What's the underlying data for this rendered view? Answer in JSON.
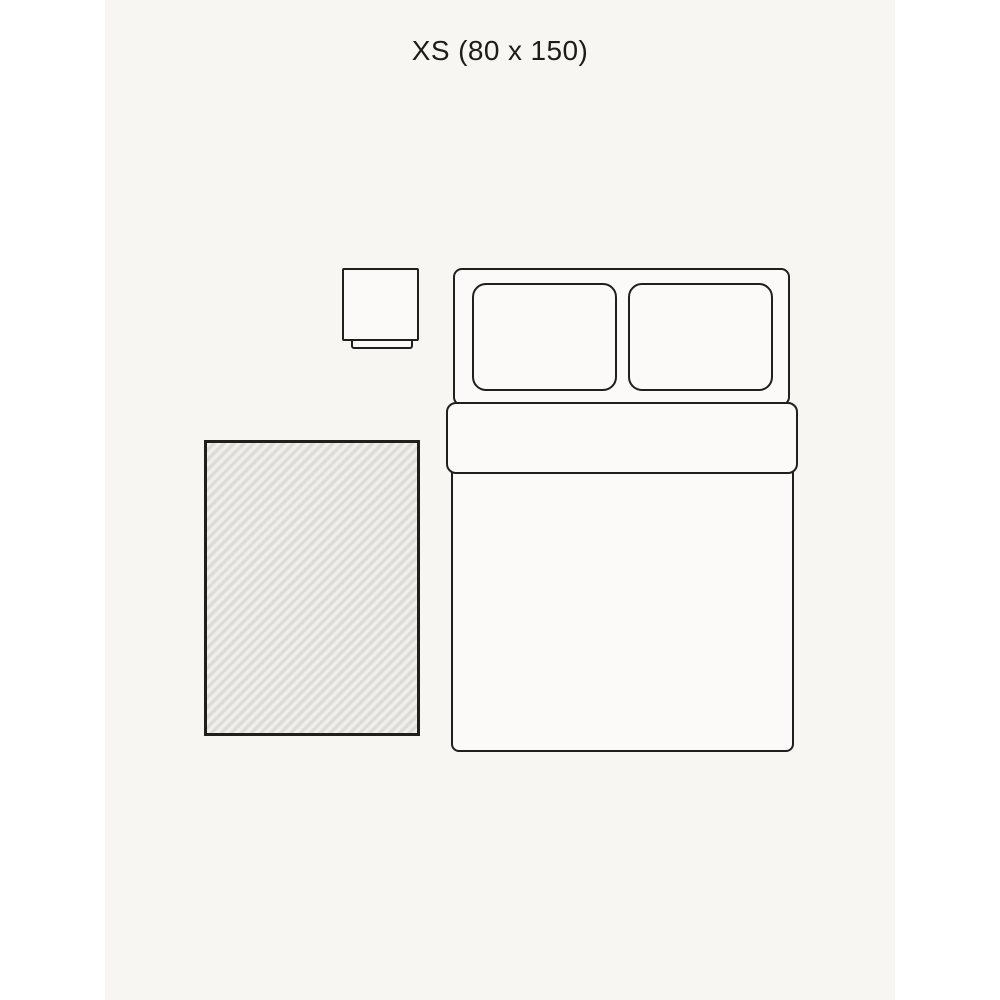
{
  "title": {
    "text": "XS (80 x 150)"
  },
  "size": {
    "label": "XS",
    "width_cm": "80",
    "length_cm": "150"
  },
  "colors": {
    "canvas": "#ffffff",
    "background": "#f7f6f3",
    "line": "#201f1d",
    "furniture_fill": "#fbfaf8",
    "rug_stripe_light": "#f0efec",
    "rug_stripe_dark": "#dddcd9",
    "text": "#1d1c1a"
  },
  "shapes": [
    {
      "name": "rug",
      "pattern": "diagonal-hatch"
    },
    {
      "name": "bed-headboard",
      "pattern": "outline"
    },
    {
      "name": "pillow-left",
      "pattern": "outline"
    },
    {
      "name": "pillow-right",
      "pattern": "outline"
    },
    {
      "name": "bed-duvet",
      "pattern": "outline"
    },
    {
      "name": "bed-duvet-fold",
      "pattern": "outline"
    },
    {
      "name": "bedside-table",
      "pattern": "outline"
    },
    {
      "name": "bedside-table-base",
      "pattern": "outline"
    }
  ]
}
